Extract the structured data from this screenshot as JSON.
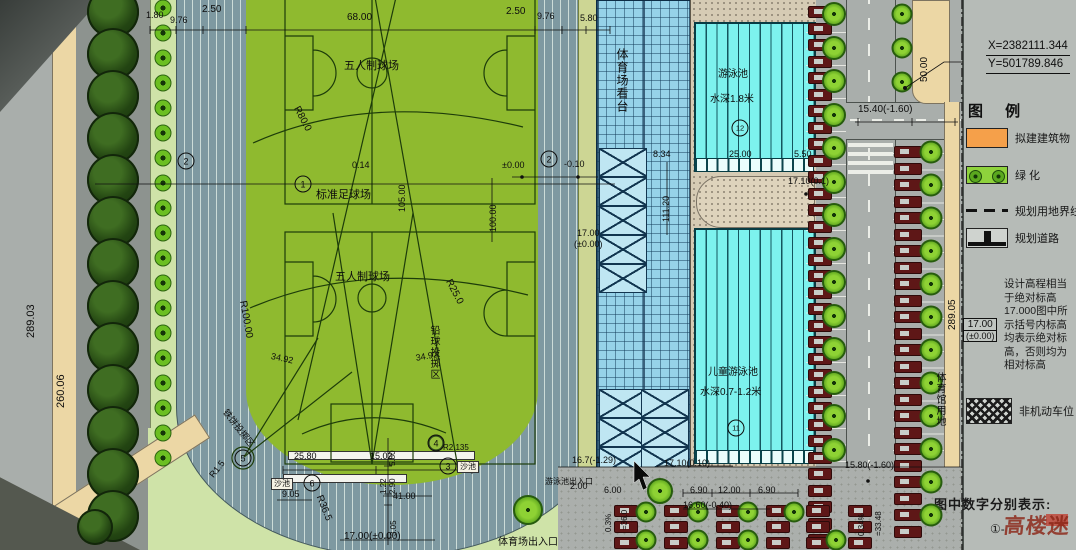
{
  "colors": {
    "field_green": "#8fba2f",
    "track": "#7e99a1",
    "pool_cyan": "#7df2ee",
    "deck_tan": "#d6cbb4",
    "road_gray": "#a9aeab",
    "panel_gray": "#b6bbb7",
    "tan": "#ecd7a5",
    "legend_orange": "#f5a04a",
    "tree_green": "#6cbf22",
    "car_maroon": "#5e1717",
    "stand_blue": "#96d2e8"
  },
  "legend": {
    "coords": {
      "x": "X=2382111.344",
      "y": "Y=501789.846"
    },
    "title": "图 例",
    "items": [
      {
        "key": "proposed-building",
        "label": "拟建建筑物"
      },
      {
        "key": "greenery",
        "label": "绿 化"
      },
      {
        "key": "land-boundary",
        "label": "规划用地界线"
      },
      {
        "key": "planned-road",
        "label": "规划道路"
      }
    ],
    "elevation_note_lines": [
      "设计高程相当",
      "于绝对标高",
      "17.000图中所",
      "示括号内标高",
      "均表示绝对标",
      "高，否则均为",
      "相对标高"
    ],
    "elevation_symbol": {
      "top": "17.00",
      "bottom": "(±0.00)"
    },
    "non_motor_label": "非机动车位",
    "bottom_note": "图中数字分别表示:",
    "bottom_item_prefix": "①-",
    "watermark": "高楼迷"
  },
  "annotations": [
    {
      "t": "1.80",
      "x": 146,
      "y": 11,
      "fs": 9
    },
    {
      "t": "9.76",
      "x": 170,
      "y": 16,
      "fs": 9
    },
    {
      "t": "2.50",
      "x": 202,
      "y": 5,
      "fs": 10
    },
    {
      "t": "68.00",
      "x": 347,
      "y": 13,
      "fs": 10
    },
    {
      "t": "2.50",
      "x": 506,
      "y": 7,
      "fs": 10
    },
    {
      "t": "9.76",
      "x": 537,
      "y": 12,
      "fs": 9
    },
    {
      "t": "5.80",
      "x": 580,
      "y": 14,
      "fs": 9
    },
    {
      "t": "五人制球场",
      "x": 344,
      "y": 61,
      "fs": 11
    },
    {
      "t": "R80.0",
      "x": 300,
      "y": 105,
      "fs": 10,
      "rot": 62
    },
    {
      "t": "0.14",
      "x": 352,
      "y": 161,
      "fs": 9
    },
    {
      "t": "105.00",
      "x": 398,
      "y": 212,
      "fs": 9,
      "rot": -90
    },
    {
      "t": "标准足球场",
      "x": 316,
      "y": 190,
      "fs": 11
    },
    {
      "t": "五人制球场",
      "x": 335,
      "y": 272,
      "fs": 11
    },
    {
      "t": "R25.0",
      "x": 452,
      "y": 278,
      "fs": 10,
      "rot": 62
    },
    {
      "t": "R100.00",
      "x": 247,
      "y": 300,
      "fs": 10,
      "rot": 80
    },
    {
      "t": "34.92",
      "x": 415,
      "y": 354,
      "fs": 9,
      "rot": -10
    },
    {
      "t": "34.92",
      "x": 272,
      "y": 352,
      "fs": 9,
      "rot": 12
    },
    {
      "t": "铅球投掷区",
      "x": 428,
      "y": 325,
      "fs": 10,
      "vert": 1
    },
    {
      "t": "铁饼投掷区",
      "x": 228,
      "y": 408,
      "fs": 9,
      "rot": 52
    },
    {
      "t": "25.80",
      "x": 294,
      "y": 452,
      "fs": 9
    },
    {
      "t": "15.02",
      "x": 370,
      "y": 452,
      "fs": 9
    },
    {
      "t": "1.22",
      "x": 380,
      "y": 494,
      "fs": 8,
      "rot": -90
    },
    {
      "t": "2.90",
      "x": 389,
      "y": 494,
      "fs": 8,
      "rot": -90
    },
    {
      "t": "5.80",
      "x": 389,
      "y": 466,
      "fs": 8,
      "rot": -90
    },
    {
      "t": "41.00",
      "x": 393,
      "y": 492,
      "fs": 9
    },
    {
      "t": "3.05",
      "x": 390,
      "y": 536,
      "fs": 8,
      "rot": -90
    },
    {
      "t": "17.00(±0.00)",
      "x": 344,
      "y": 532,
      "fs": 10
    },
    {
      "t": "9.05",
      "x": 282,
      "y": 490,
      "fs": 9
    },
    {
      "t": "R36.5",
      "x": 323,
      "y": 494,
      "fs": 10,
      "rot": 68
    },
    {
      "t": "R1.5",
      "x": 208,
      "y": 474,
      "fs": 9,
      "rot": -52
    },
    {
      "t": "R2.135",
      "x": 443,
      "y": 444,
      "fs": 8
    },
    {
      "t": "沙池",
      "x": 457,
      "y": 461,
      "fs": 8,
      "box": 1
    },
    {
      "t": "沙池",
      "x": 271,
      "y": 478,
      "fs": 8,
      "box": 1
    },
    {
      "t": "体育场出入口",
      "x": 498,
      "y": 538,
      "fs": 10
    },
    {
      "t": "游泳池出入口",
      "x": 545,
      "y": 478,
      "fs": 8
    },
    {
      "t": "2.00",
      "x": 570,
      "y": 482,
      "fs": 9
    },
    {
      "t": "6.00",
      "x": 604,
      "y": 486,
      "fs": 9
    },
    {
      "t": "16.7(-1.29)",
      "x": 572,
      "y": 456,
      "fs": 9
    },
    {
      "t": "17.10(0.10)",
      "x": 664,
      "y": 459,
      "fs": 9
    },
    {
      "t": "6.90",
      "x": 690,
      "y": 486,
      "fs": 9
    },
    {
      "t": "12.00",
      "x": 718,
      "y": 486,
      "fs": 9
    },
    {
      "t": "6.90",
      "x": 758,
      "y": 486,
      "fs": 9
    },
    {
      "t": "16.60(-0.40)",
      "x": 683,
      "y": 501,
      "fs": 9
    },
    {
      "t": "=36.0",
      "x": 621,
      "y": 530,
      "fs": 8,
      "rot": -90
    },
    {
      "t": "0.3%",
      "x": 605,
      "y": 532,
      "fs": 8,
      "rot": -90
    },
    {
      "t": "±0.00",
      "x": 502,
      "y": 161,
      "fs": 9
    },
    {
      "t": "-0.10",
      "x": 564,
      "y": 160,
      "fs": 9
    },
    {
      "t": "100.00",
      "x": 489,
      "y": 232,
      "fs": 9,
      "rot": -90
    },
    {
      "t": "17.00",
      "x": 577,
      "y": 229,
      "fs": 9
    },
    {
      "t": "(±0.00)",
      "x": 574,
      "y": 240,
      "fs": 9
    },
    {
      "t": "体育场看台",
      "x": 616,
      "y": 48,
      "fs": 12,
      "vert": 1
    },
    {
      "t": "8.34",
      "x": 653,
      "y": 150,
      "fs": 9
    },
    {
      "t": "111.20",
      "x": 662,
      "y": 222,
      "fs": 9,
      "rot": -90
    },
    {
      "t": "游泳池",
      "x": 718,
      "y": 70,
      "fs": 10
    },
    {
      "t": "水深1.8米",
      "x": 710,
      "y": 95,
      "fs": 10
    },
    {
      "t": "25.00",
      "x": 729,
      "y": 150,
      "fs": 9
    },
    {
      "t": "5.50",
      "x": 794,
      "y": 150,
      "fs": 9
    },
    {
      "t": "17.10(0.1)",
      "x": 788,
      "y": 177,
      "fs": 9
    },
    {
      "t": "儿童游泳池",
      "x": 708,
      "y": 368,
      "fs": 10
    },
    {
      "t": "水深0.7-1.2米",
      "x": 700,
      "y": 388,
      "fs": 10
    },
    {
      "t": "15.40(-1.60)",
      "x": 858,
      "y": 105,
      "fs": 10
    },
    {
      "t": "50.00",
      "x": 920,
      "y": 82,
      "fs": 10,
      "rot": -90
    },
    {
      "t": "289.03",
      "x": 26,
      "y": 338,
      "fs": 11,
      "rot": -90
    },
    {
      "t": "260.06",
      "x": 56,
      "y": 408,
      "fs": 11,
      "rot": -90
    },
    {
      "t": "289.05",
      "x": 948,
      "y": 330,
      "fs": 10,
      "rot": -90
    },
    {
      "t": "体育馆用地",
      "x": 934,
      "y": 372,
      "fs": 10,
      "vert": 1
    },
    {
      "t": "15.80(-1.60)",
      "x": 845,
      "y": 461,
      "fs": 9
    },
    {
      "t": "0.34%",
      "x": 858,
      "y": 536,
      "fs": 8,
      "rot": -90
    },
    {
      "t": "=33.48",
      "x": 875,
      "y": 536,
      "fs": 8,
      "rot": -90
    }
  ],
  "circled_numbers": [
    {
      "n": "1",
      "x": 303,
      "y": 184
    },
    {
      "n": "2",
      "x": 186,
      "y": 161
    },
    {
      "n": "2",
      "x": 549,
      "y": 159
    },
    {
      "n": "3",
      "x": 448,
      "y": 466
    },
    {
      "n": "4",
      "x": 436,
      "y": 443
    },
    {
      "n": "5",
      "x": 243,
      "y": 458
    },
    {
      "n": "6",
      "x": 312,
      "y": 483
    },
    {
      "n": "11",
      "x": 736,
      "y": 428
    },
    {
      "n": "12",
      "x": 740,
      "y": 128
    }
  ]
}
